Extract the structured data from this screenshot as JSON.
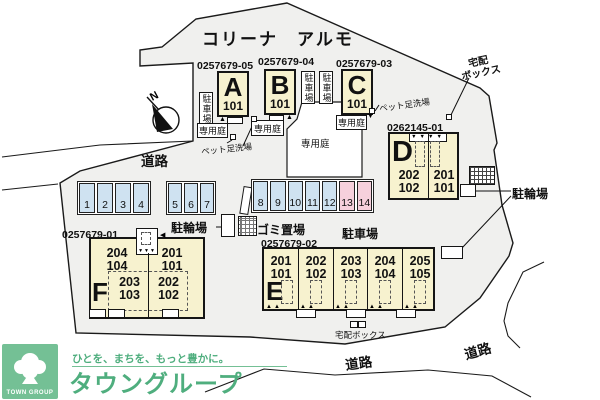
{
  "site": {
    "title": "コリーナ　アルモ",
    "compass_n": "N"
  },
  "roads": {
    "left": "道路",
    "bottom_center": "道路",
    "bottom_right": "道路"
  },
  "labels": {
    "parking_vertical": "駐車場",
    "parking": "駐車場",
    "bike": "駐輪場",
    "garbage": "ゴミ置場",
    "garden": "専用庭",
    "pet_wash": "ペット足洗場",
    "delivery": "宅配ボックス",
    "delivery_l1": "宅配",
    "delivery_l2": "ボックス"
  },
  "buildings": {
    "a": {
      "code": "0257679-05",
      "letter": "A",
      "unit": "101"
    },
    "b": {
      "code": "0257679-04",
      "letter": "B",
      "unit": "101"
    },
    "c": {
      "code": "0257679-03",
      "letter": "C",
      "unit": "101"
    },
    "d": {
      "code": "0262145-01",
      "letter": "D",
      "cols": [
        {
          "u2": "202",
          "u1": "102"
        },
        {
          "u2": "201",
          "u1": "101"
        }
      ]
    },
    "e": {
      "code": "0257679-02",
      "letter": "E",
      "cols": [
        {
          "u2": "201",
          "u1": "101"
        },
        {
          "u2": "202",
          "u1": "102"
        },
        {
          "u2": "203",
          "u1": "103"
        },
        {
          "u2": "204",
          "u1": "104"
        },
        {
          "u2": "205",
          "u1": "105"
        }
      ]
    },
    "f": {
      "code": "0257679-01",
      "letter": "F",
      "top": [
        {
          "u2": "204",
          "u1": "104"
        },
        {
          "u2": "201",
          "u1": "101"
        }
      ],
      "bottom": [
        {
          "u2": "203",
          "u1": "103"
        },
        {
          "u2": "202",
          "u1": "102"
        }
      ]
    }
  },
  "parking": {
    "spaces": [
      "1",
      "2",
      "3",
      "4",
      "5",
      "6",
      "7",
      "8",
      "9",
      "10",
      "11",
      "12",
      "13",
      "14"
    ]
  },
  "icons": {
    "porch_marker_up": "▲",
    "pair_up": "▲▲",
    "d_entry_row": "▼▼▼▼",
    "f_shaft_row": "▼▼▼",
    "left_tri": "◀",
    "down_tri": "▼"
  },
  "colors": {
    "site": "#f0f0ee",
    "building": "#f7f2cf",
    "space_blue": "#cfe2f1",
    "space_pink": "#f6d0dc",
    "brand_green": "#74c095"
  },
  "logo": {
    "tagline": "ひとを、まちを、もっと豊かに。",
    "name": "タウングループ",
    "mark": "TOWN GROUP"
  }
}
